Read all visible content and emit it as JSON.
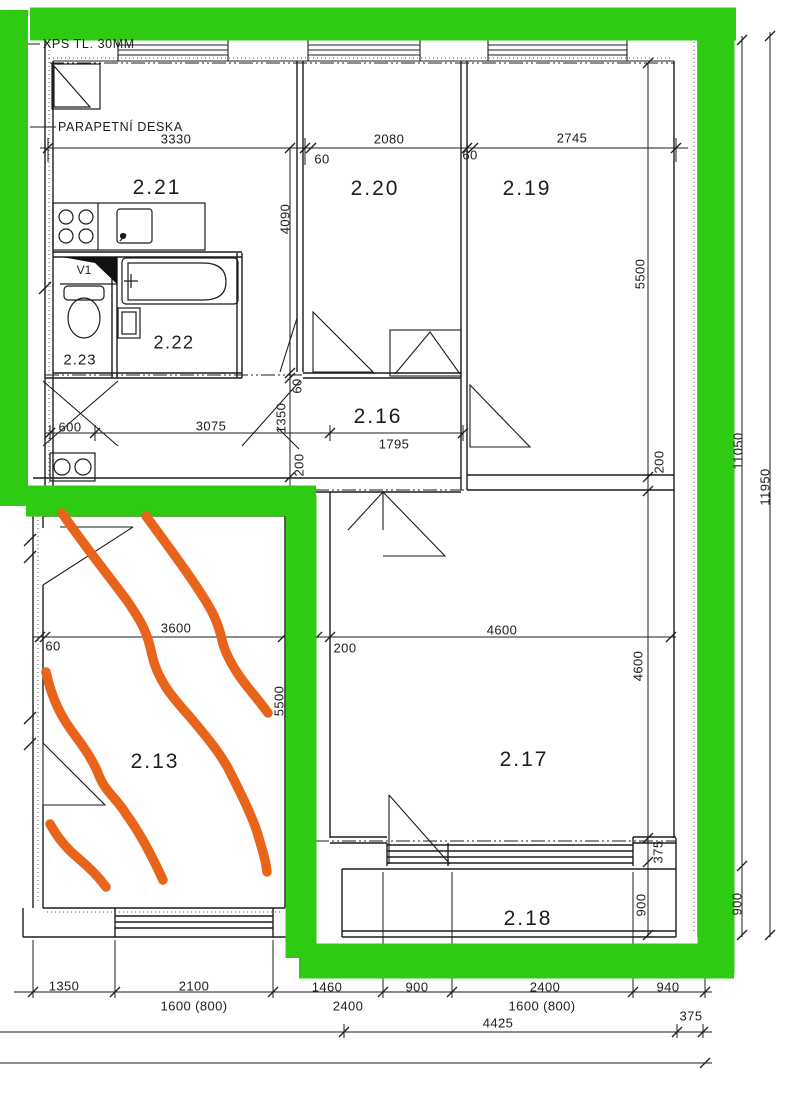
{
  "plan": {
    "colors": {
      "highlight": "#2ecb12",
      "marker": "#e8641a",
      "ink": "#1d1d1d"
    },
    "notes": [
      {
        "text": "XPS TL. 30MM"
      },
      {
        "text": "PARAPETNÍ DESKA"
      }
    ],
    "rooms": [
      {
        "label": "2.21"
      },
      {
        "label": "2.20"
      },
      {
        "label": "2.19"
      },
      {
        "label": "2.16"
      },
      {
        "label": "2.22"
      },
      {
        "label": "2.23"
      },
      {
        "label": "2.13"
      },
      {
        "label": "2.17"
      },
      {
        "label": "2.18"
      },
      {
        "label": "V1"
      }
    ],
    "h_dims": [
      {
        "text": "3330"
      },
      {
        "text": "2080"
      },
      {
        "text": "2745"
      },
      {
        "text": "60"
      },
      {
        "text": "60"
      },
      {
        "text": "600"
      },
      {
        "text": "3075"
      },
      {
        "text": "1795"
      },
      {
        "text": "3600"
      },
      {
        "text": "200"
      },
      {
        "text": "4600"
      },
      {
        "text": "60"
      },
      {
        "text": "1350"
      },
      {
        "text": "2100"
      },
      {
        "text": "1460"
      },
      {
        "text": "900"
      },
      {
        "text": "2400"
      },
      {
        "text": "940"
      },
      {
        "text": "1600 (800)"
      },
      {
        "text": "2400"
      },
      {
        "text": "1600 (800)"
      },
      {
        "text": "4425"
      },
      {
        "text": "375"
      }
    ],
    "v_dims": [
      {
        "text": "4090"
      },
      {
        "text": "5500"
      },
      {
        "text": "200"
      },
      {
        "text": "60"
      },
      {
        "text": "1350"
      },
      {
        "text": "200"
      },
      {
        "text": "5500"
      },
      {
        "text": "4600"
      },
      {
        "text": "375"
      },
      {
        "text": "900"
      },
      {
        "text": "11050"
      },
      {
        "text": "900"
      },
      {
        "text": "11950"
      }
    ]
  }
}
